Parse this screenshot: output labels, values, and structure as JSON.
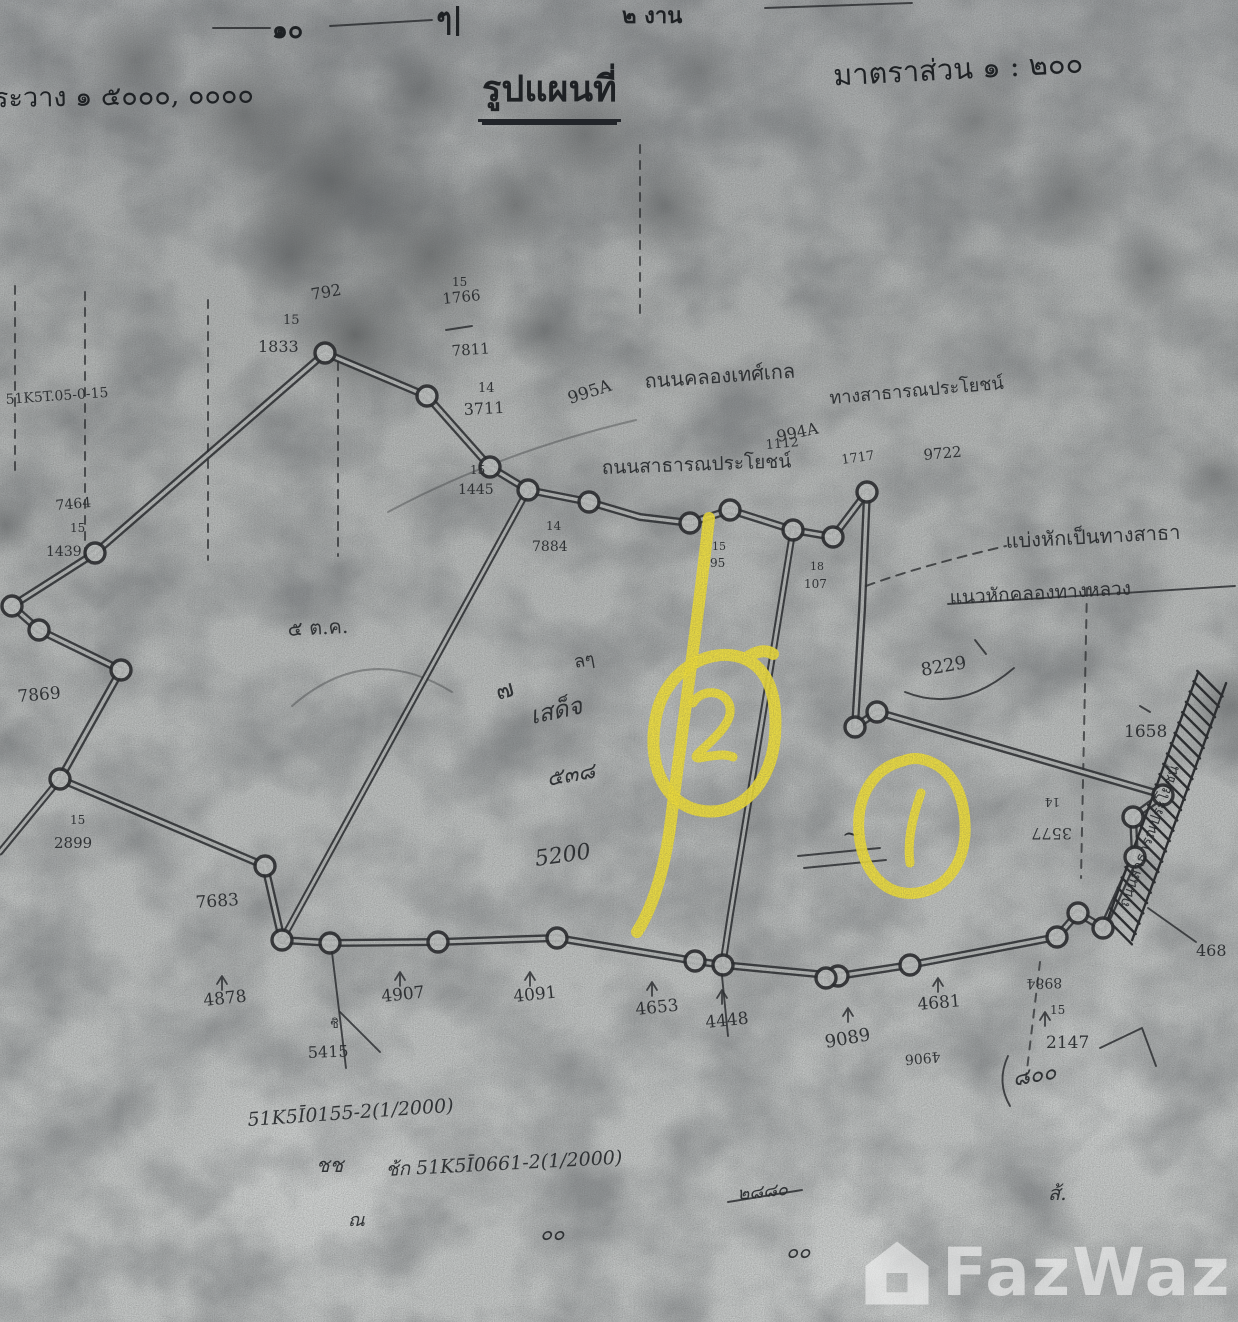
{
  "header": {
    "measure_10": "๑๐",
    "measure_mark": "ๆ|",
    "measure_ngan": "๒ งาน",
    "survey_sheet_label": "ระวาง ๑ ๕๐๐๐, ๐๐๐๐",
    "title": "รูปแผนที่",
    "scale_label": "มาตราส่วน ๑ : ๒๐๐"
  },
  "watermark": {
    "brand": "FazWaz",
    "logo": "house-logo"
  },
  "annotations": {
    "highlight_color": "#f2e138",
    "items": [
      {
        "type": "circled-number",
        "label": "2"
      },
      {
        "type": "circled-number",
        "label": "1"
      },
      {
        "type": "divider-stroke",
        "label": ""
      }
    ],
    "paths": [
      {
        "d": "M709,518 C698,620 682,730 671,820 C664,876 650,912 637,932",
        "w": 12
      },
      {
        "d": "M745,659 C713,645 668,668 657,712 C645,762 664,806 703,811 C741,816 772,783 775,735 C778,692 766,668 745,659 M745,659 C755,651 766,649 773,654",
        "w": 12
      },
      {
        "d": "M903,761 C873,768 856,797 859,833 C862,872 886,897 917,893 C948,889 967,860 965,823 C963,789 949,765 921,759 C915,758 908,759 903,761",
        "w": 11
      },
      {
        "d": "M693,703 C700,690 722,688 729,704 C735,719 718,735 704,748 C697,754 693,758 699,758 C711,756 724,753 733,757",
        "w": 9
      },
      {
        "d": "M921,793 C912,818 907,842 910,863",
        "w": 9
      }
    ]
  },
  "map": {
    "ink": "#26282b",
    "paper_line": "#c1c4c3",
    "double_lines": [
      {
        "w": 8,
        "closed": true,
        "pts": [
          [
            95,
            553
          ],
          [
            325,
            353
          ],
          [
            427,
            396
          ],
          [
            490,
            467
          ],
          [
            528,
            490
          ],
          [
            589,
            502
          ],
          [
            640,
            517
          ],
          [
            690,
            523
          ],
          [
            730,
            510
          ],
          [
            793,
            530
          ],
          [
            833,
            537
          ],
          [
            867,
            492
          ],
          [
            862,
            610
          ],
          [
            855,
            727
          ],
          [
            877,
            712
          ],
          [
            1163,
            795
          ],
          [
            1133,
            817
          ],
          [
            1135,
            857
          ],
          [
            1103,
            928
          ],
          [
            1078,
            913
          ],
          [
            1057,
            937
          ],
          [
            910,
            965
          ],
          [
            838,
            976
          ],
          [
            723,
            965
          ],
          [
            695,
            961
          ],
          [
            557,
            938
          ],
          [
            438,
            942
          ],
          [
            330,
            943
          ],
          [
            282,
            940
          ],
          [
            265,
            866
          ],
          [
            60,
            779
          ],
          [
            121,
            670
          ],
          [
            39,
            630
          ],
          [
            12,
            606
          ]
        ]
      },
      {
        "w": 7,
        "closed": false,
        "pts": [
          [
            528,
            490
          ],
          [
            282,
            940
          ]
        ]
      },
      {
        "w": 7,
        "closed": false,
        "pts": [
          [
            793,
            530
          ],
          [
            780,
            610
          ],
          [
            730,
            917
          ],
          [
            723,
            963
          ]
        ]
      },
      {
        "w": 7,
        "closed": false,
        "pts": [
          [
            60,
            779
          ],
          [
            0,
            852
          ]
        ]
      }
    ],
    "vertices": [
      [
        325,
        353
      ],
      [
        427,
        396
      ],
      [
        490,
        467
      ],
      [
        528,
        490
      ],
      [
        589,
        502
      ],
      [
        690,
        523
      ],
      [
        730,
        510
      ],
      [
        793,
        530
      ],
      [
        833,
        537
      ],
      [
        867,
        492
      ],
      [
        855,
        727
      ],
      [
        877,
        712
      ],
      [
        1163,
        795
      ],
      [
        1133,
        817
      ],
      [
        1135,
        857
      ],
      [
        1078,
        913
      ],
      [
        1103,
        928
      ],
      [
        1057,
        937
      ],
      [
        910,
        965
      ],
      [
        838,
        976
      ],
      [
        826,
        978
      ],
      [
        723,
        965
      ],
      [
        695,
        961
      ],
      [
        557,
        938
      ],
      [
        438,
        942
      ],
      [
        330,
        943
      ],
      [
        282,
        940
      ],
      [
        265,
        866
      ],
      [
        60,
        779
      ],
      [
        121,
        670
      ],
      [
        39,
        630
      ],
      [
        95,
        553
      ],
      [
        12,
        606
      ]
    ],
    "dashed_lines": [
      [
        [
          85,
          292
        ],
        [
          85,
          558
        ]
      ],
      [
        [
          208,
          300
        ],
        [
          208,
          560
        ]
      ],
      [
        [
          338,
          362
        ],
        [
          338,
          556
        ]
      ],
      [
        [
          640,
          145
        ],
        [
          640,
          315
        ]
      ],
      [
        [
          1087,
          588
        ],
        [
          1081,
          878
        ]
      ],
      [
        [
          1040,
          962
        ],
        [
          1026,
          1078
        ]
      ],
      [
        [
          15,
          286
        ],
        [
          15,
          470
        ]
      ]
    ],
    "dashed_paths": [
      "M866,586 Q920,566 1006,546"
    ],
    "extra_lines": [
      [
        [
          948,
          604
        ],
        [
          1235,
          586
        ]
      ],
      [
        [
          798,
          856
        ],
        [
          880,
          848
        ]
      ],
      [
        [
          804,
          868
        ],
        [
          886,
          860
        ]
      ],
      [
        [
          728,
          1202
        ],
        [
          802,
          1190
        ]
      ],
      [
        [
          331,
          944
        ],
        [
          346,
          1068
        ]
      ],
      [
        [
          721,
          966
        ],
        [
          728,
          1036
        ]
      ],
      [
        [
          340,
          1012
        ],
        [
          380,
          1052
        ]
      ],
      [
        [
          1140,
          706
        ],
        [
          1150,
          712
        ]
      ],
      [
        [
          1148,
          908
        ],
        [
          1196,
          942
        ]
      ],
      [
        [
          213,
          28
        ],
        [
          270,
          28
        ]
      ],
      [
        [
          330,
          26
        ],
        [
          432,
          20
        ]
      ],
      [
        [
          765,
          8
        ],
        [
          912,
          3
        ]
      ],
      [
        [
          446,
          330
        ],
        [
          472,
          326
        ]
      ],
      [
        [
          975,
          640
        ],
        [
          986,
          654
        ]
      ]
    ],
    "extra_paths": [
      "M905,692 Q960,714 1014,668",
      "M1008,1056 Q996,1082 1010,1106",
      "M1100,1048 L1142,1028 L1156,1066"
    ],
    "faint_paths": [
      "M388,512 Q500,452 636,420",
      "M292,706 Q368,640 452,692"
    ],
    "ticks": [
      [
        222,
        990
      ],
      [
        400,
        986
      ],
      [
        530,
        986
      ],
      [
        652,
        996
      ],
      [
        722,
        1004
      ],
      [
        848,
        1022
      ],
      [
        938,
        992
      ],
      [
        1045,
        1026
      ]
    ],
    "road_band": {
      "from": [
        1212,
        678
      ],
      "to": [
        1118,
        935
      ],
      "width": 30
    },
    "labels": [
      {
        "t": "792",
        "x": 312,
        "y": 300,
        "s": 16,
        "r": -10
      },
      {
        "t": "15",
        "x": 283,
        "y": 324,
        "s": 13
      },
      {
        "t": "1833",
        "x": 258,
        "y": 352,
        "s": 16
      },
      {
        "t": "15",
        "x": 452,
        "y": 286,
        "s": 12
      },
      {
        "t": "1766",
        "x": 443,
        "y": 304,
        "s": 15,
        "r": -6
      },
      {
        "t": "7811",
        "x": 452,
        "y": 356,
        "s": 15,
        "r": -4
      },
      {
        "t": "14",
        "x": 478,
        "y": 392,
        "s": 13
      },
      {
        "t": "3711",
        "x": 464,
        "y": 415,
        "s": 16,
        "r": -3
      },
      {
        "t": "995A",
        "x": 570,
        "y": 404,
        "s": 17,
        "r": -18
      },
      {
        "t": "994A",
        "x": 778,
        "y": 442,
        "s": 16,
        "r": -12
      },
      {
        "t": "ถนนคลองเทศ์เกล",
        "x": 645,
        "y": 388,
        "s": 20,
        "r": -4
      },
      {
        "t": "ทางสาธารณประโยชน์",
        "x": 830,
        "y": 404,
        "s": 18,
        "r": -5
      },
      {
        "t": "1112",
        "x": 766,
        "y": 449,
        "s": 13,
        "r": -5
      },
      {
        "t": "1717",
        "x": 842,
        "y": 464,
        "s": 13,
        "r": -8
      },
      {
        "t": "9722",
        "x": 924,
        "y": 460,
        "s": 15,
        "r": -5
      },
      {
        "t": "ถนนสาธารณประโยชน์",
        "x": 602,
        "y": 474,
        "s": 19,
        "r": -2
      },
      {
        "t": "15",
        "x": 470,
        "y": 474,
        "s": 12
      },
      {
        "t": "1445",
        "x": 458,
        "y": 494,
        "s": 14
      },
      {
        "t": "14",
        "x": 546,
        "y": 530,
        "s": 12
      },
      {
        "t": "7884",
        "x": 532,
        "y": 551,
        "s": 14
      },
      {
        "t": "15",
        "x": 712,
        "y": 550,
        "s": 11
      },
      {
        "t": "95",
        "x": 710,
        "y": 567,
        "s": 12
      },
      {
        "t": "18",
        "x": 810,
        "y": 570,
        "s": 11
      },
      {
        "t": "107",
        "x": 804,
        "y": 588,
        "s": 12
      },
      {
        "t": "แบ่งหักเป็นทางสาธา",
        "x": 1006,
        "y": 548,
        "s": 20,
        "r": -3
      },
      {
        "t": "แนวหักคลองทางหลวง",
        "x": 950,
        "y": 604,
        "s": 19,
        "r": -3
      },
      {
        "t": "8229",
        "x": 922,
        "y": 676,
        "s": 18,
        "r": -10
      },
      {
        "t": "1658",
        "x": 1124,
        "y": 737,
        "s": 17
      },
      {
        "t": "14",
        "x": 1060,
        "y": 798,
        "s": 12,
        "r": 180
      },
      {
        "t": "3577",
        "x": 1072,
        "y": 828,
        "s": 16,
        "r": 180
      },
      {
        "t": "๕ ต.ค.",
        "x": 288,
        "y": 636,
        "s": 20,
        "r": -3
      },
      {
        "t": "ลๆ",
        "x": 575,
        "y": 668,
        "s": 18,
        "r": -10
      },
      {
        "t": "๗",
        "x": 498,
        "y": 700,
        "s": 24,
        "r": -15
      },
      {
        "t": "เสด็จ",
        "x": 532,
        "y": 724,
        "s": 24,
        "r": -12,
        "hand": true
      },
      {
        "t": "๕๓๘",
        "x": 548,
        "y": 786,
        "s": 22,
        "r": -10,
        "hand": true
      },
      {
        "t": "5200",
        "x": 536,
        "y": 866,
        "s": 22,
        "r": -8,
        "hand": true
      },
      {
        "t": "7869",
        "x": 18,
        "y": 702,
        "s": 17,
        "r": -5
      },
      {
        "t": "15",
        "x": 70,
        "y": 824,
        "s": 12
      },
      {
        "t": "2899",
        "x": 54,
        "y": 848,
        "s": 15
      },
      {
        "t": "7464",
        "x": 56,
        "y": 510,
        "s": 14,
        "r": -5
      },
      {
        "t": "15",
        "x": 70,
        "y": 532,
        "s": 12
      },
      {
        "t": "1439",
        "x": 46,
        "y": 556,
        "s": 14
      },
      {
        "t": "51K5T.05-0-15",
        "x": 6,
        "y": 404,
        "s": 14,
        "r": -4
      },
      {
        "t": "7683",
        "x": 196,
        "y": 908,
        "s": 17,
        "r": -4
      },
      {
        "t": "4878",
        "x": 204,
        "y": 1006,
        "s": 17,
        "r": -6
      },
      {
        "t": "ชิ",
        "x": 330,
        "y": 1028,
        "s": 13
      },
      {
        "t": "5415",
        "x": 308,
        "y": 1058,
        "s": 16,
        "r": -2
      },
      {
        "t": "4907",
        "x": 382,
        "y": 1002,
        "s": 17,
        "r": -6
      },
      {
        "t": "4091",
        "x": 514,
        "y": 1002,
        "s": 17,
        "r": -6
      },
      {
        "t": "4653",
        "x": 636,
        "y": 1015,
        "s": 17,
        "r": -6
      },
      {
        "t": "4448",
        "x": 706,
        "y": 1028,
        "s": 17,
        "r": -6
      },
      {
        "t": "9089",
        "x": 826,
        "y": 1048,
        "s": 18,
        "r": -10
      },
      {
        "t": "4681",
        "x": 918,
        "y": 1010,
        "s": 17,
        "r": -5
      },
      {
        "t": "4906",
        "x": 940,
        "y": 1052,
        "s": 14,
        "r": 175
      },
      {
        "t": "8984",
        "x": 1062,
        "y": 978,
        "s": 14,
        "r": 178
      },
      {
        "t": "15",
        "x": 1050,
        "y": 1014,
        "s": 12
      },
      {
        "t": "2147",
        "x": 1046,
        "y": 1048,
        "s": 17
      },
      {
        "t": "468",
        "x": 1196,
        "y": 956,
        "s": 16
      },
      {
        "t": "๘๐๐",
        "x": 1014,
        "y": 1086,
        "s": 22,
        "r": -10,
        "hand": true
      },
      {
        "t": "51K5Ī0155-2(1/2000)",
        "x": 248,
        "y": 1126,
        "s": 19,
        "r": -4,
        "hand": true
      },
      {
        "t": "ชช",
        "x": 316,
        "y": 1172,
        "s": 20,
        "hand": true
      },
      {
        "t": "ช้ก 51K5Ī0661-2(1/2000)",
        "x": 386,
        "y": 1176,
        "s": 19,
        "r": -3,
        "hand": true
      },
      {
        "t": "๒๘๘๐",
        "x": 738,
        "y": 1200,
        "s": 18,
        "r": -6,
        "hand": true
      },
      {
        "t": "ณ",
        "x": 348,
        "y": 1226,
        "s": 18,
        "hand": true
      },
      {
        "t": "๐๐",
        "x": 540,
        "y": 1240,
        "s": 20,
        "hand": true
      },
      {
        "t": "๐๐",
        "x": 786,
        "y": 1258,
        "s": 20,
        "hand": true
      },
      {
        "t": "ส้.",
        "x": 1048,
        "y": 1200,
        "s": 20,
        "hand": true
      },
      {
        "t": "~",
        "x": 842,
        "y": 842,
        "s": 24
      },
      {
        "t": "ถนนสาธารณประโยชน์",
        "x": 1128,
        "y": 908,
        "s": 15,
        "r": -70
      }
    ]
  }
}
